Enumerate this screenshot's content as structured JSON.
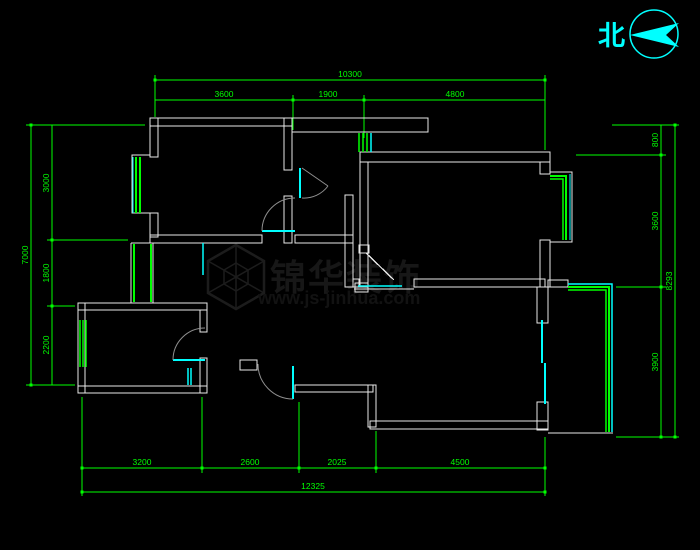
{
  "drawing": {
    "type": "floor-plan",
    "background": "#000000"
  },
  "north": {
    "label": "北"
  },
  "watermark": {
    "brand": "锦华装饰",
    "url": "www.js-jinhua.com"
  },
  "dims": {
    "top_overall": "10300",
    "top_segs": [
      "3600",
      "1900",
      "4800"
    ],
    "left_overall": "7000",
    "left_segs": [
      "3000",
      "1800",
      "2200"
    ],
    "right_overall": "8293",
    "right_segs": [
      "800",
      "3600",
      "3900"
    ],
    "bottom_overall": "12325",
    "bottom_segs": [
      "3200",
      "2600",
      "2025",
      "4500"
    ]
  },
  "colors": {
    "dimension": "#00ff00",
    "wall": "#ffffff",
    "window": "#00ff00",
    "door_leaf": "#00ffff",
    "door_arc": "#8f8f8f",
    "north_symbol": "#00ffff",
    "watermark": "#1c1c1c"
  }
}
